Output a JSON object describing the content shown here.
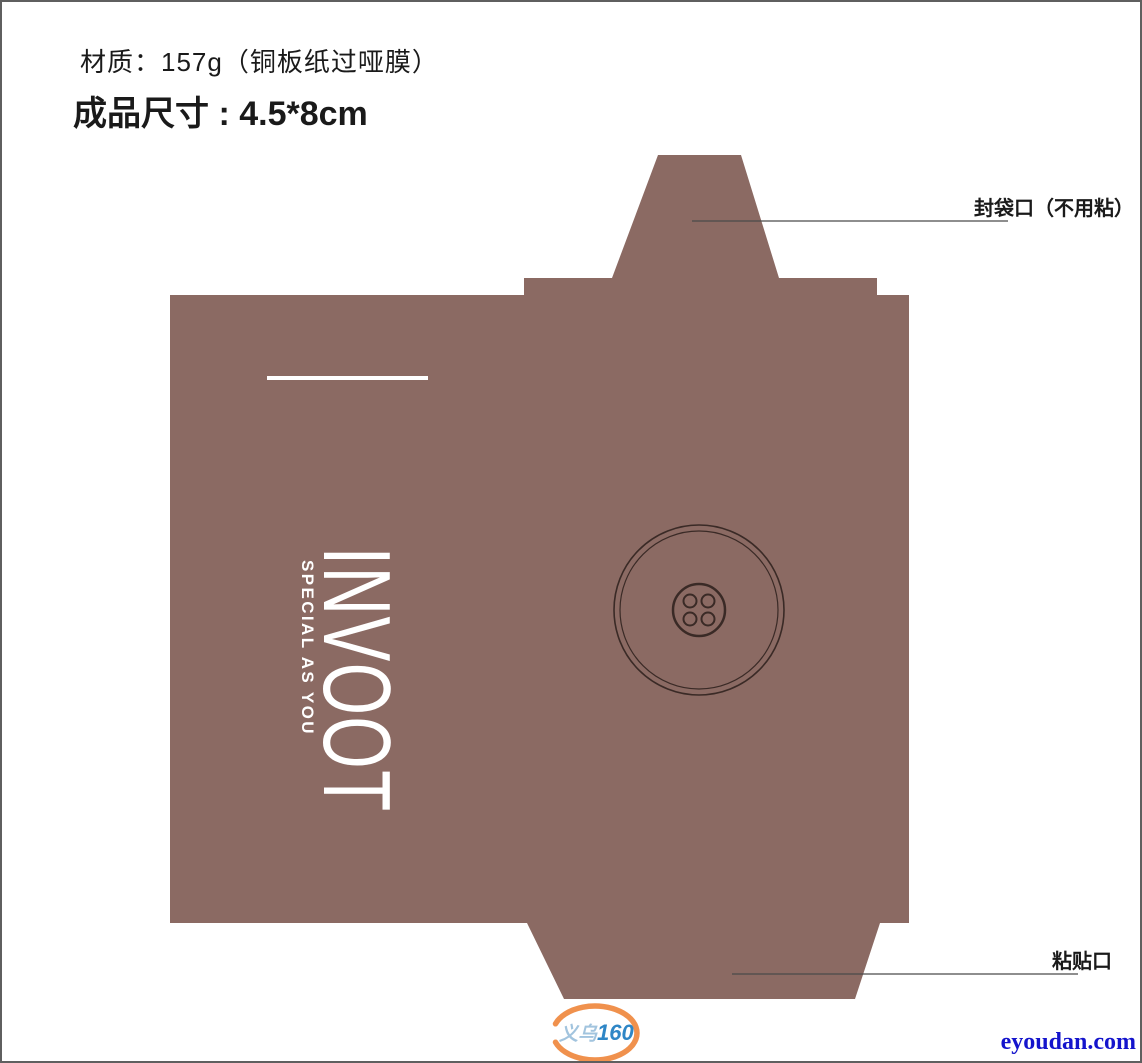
{
  "header": {
    "material_line": "材质：157g（铜板纸过哑膜）",
    "size_line": "成品尺寸 : 4.5*8cm"
  },
  "callouts": {
    "top_flap_label": "封袋口（不用粘）",
    "bottom_flap_label": "粘贴口"
  },
  "artwork": {
    "brand_name": "INVOOT",
    "brand_tagline": "SPECIAL AS YOU"
  },
  "watermark": {
    "logo_text_cn": "义乌",
    "logo_text_num": "160",
    "website": "eyoudan.com"
  },
  "colors": {
    "paper-brown": "#8b6a63",
    "outline-dark": "#3a2a26",
    "leader-line": "#4a4a4a",
    "text-black": "#1a1a1a",
    "website-blue": "#1414cc",
    "logo-blue": "#2e86c6",
    "logo-lightblue": "#a2c4de",
    "logo-orange": "#f0914d",
    "artwork-white": "#ffffff"
  }
}
